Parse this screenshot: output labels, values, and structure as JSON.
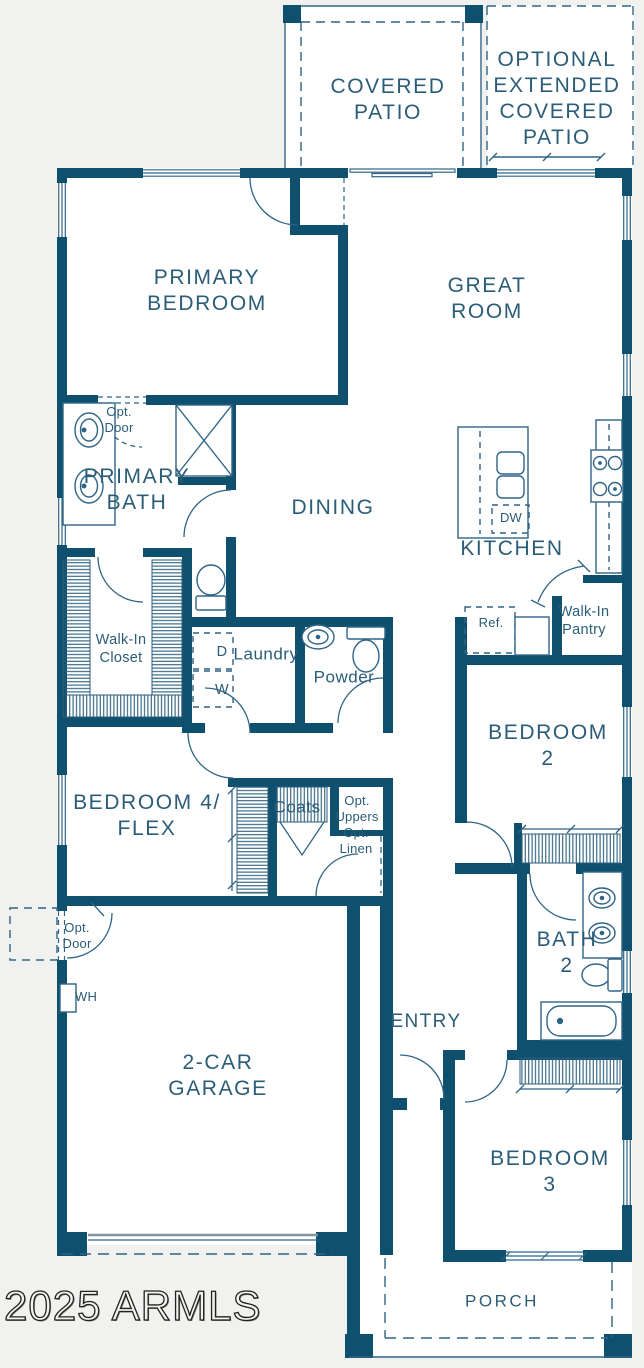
{
  "colors": {
    "wall": "#10506f",
    "thin_line": "#2f6486",
    "label_text": "#2b5c78",
    "background": "#f1f1ef",
    "floor": "#ffffff",
    "garage_door_gray": "#7f93a3"
  },
  "watermark": "2025 ARMLS",
  "plan": {
    "patio": {
      "covered": [
        "COVERED",
        "PATIO"
      ],
      "optional": [
        "OPTIONAL",
        "EXTENDED",
        "COVERED",
        "PATIO"
      ]
    },
    "rooms": {
      "primary_bedroom": [
        "PRIMARY",
        "BEDROOM"
      ],
      "great_room": [
        "GREAT",
        "ROOM"
      ],
      "dining": [
        "DINING"
      ],
      "kitchen": [
        "KITCHEN"
      ],
      "primary_bath": [
        "PRIMARY",
        "BATH"
      ],
      "walk_in_closet": [
        "Walk-In",
        "Closet"
      ],
      "laundry": [
        "Laundry"
      ],
      "powder": [
        "Powder"
      ],
      "walk_in_pantry": [
        "Walk-In",
        "Pantry"
      ],
      "bedroom2": [
        "BEDROOM 2"
      ],
      "bedroom4_flex": [
        "BEDROOM 4/",
        "FLEX"
      ],
      "bath2": [
        "BATH",
        "2"
      ],
      "entry": [
        "ENTRY"
      ],
      "garage": [
        "2-CAR",
        "GARAGE"
      ],
      "bedroom3": [
        "BEDROOM 3"
      ],
      "porch": [
        "PORCH"
      ]
    },
    "fixtures": {
      "dishwasher": "DW",
      "refrigerator": "Ref.",
      "dryer": "D",
      "washer": "W",
      "water_heater": "WH",
      "coats": "Coats",
      "opt_uppers": [
        "Opt.",
        "Uppers"
      ],
      "opt_linen": [
        "Opt.",
        "Linen"
      ],
      "opt_door_bath": [
        "Opt.",
        "Door"
      ],
      "opt_door_garage": [
        "Opt.",
        "Door"
      ]
    }
  }
}
